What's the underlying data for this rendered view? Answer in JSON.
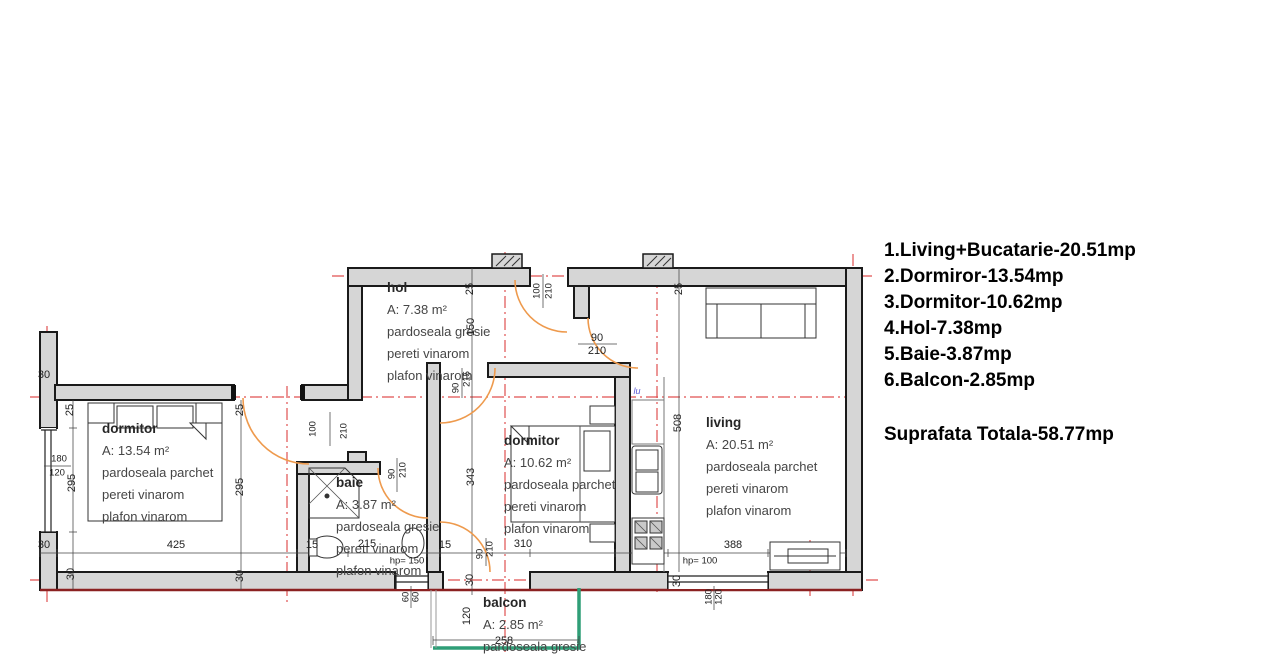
{
  "legend": {
    "items": [
      "1.Living+Bucatarie-20.51mp",
      "2.Dormiror-13.54mp",
      "3.Dormitor-10.62mp",
      "4.Hol-7.38mp",
      "5.Baie-3.87mp",
      "6.Balcon-2.85mp"
    ],
    "total": "Suprafata Totala-58.77mp"
  },
  "rooms": {
    "hol": {
      "name": "hol",
      "area": "A: 7.38 m²",
      "lines": [
        "pardoseala gresie",
        "pereti vinarom",
        "plafon vinarom"
      ]
    },
    "dormitor1": {
      "name": "dormitor",
      "area": "A: 13.54 m²",
      "lines": [
        "pardoseala parchet",
        "pereti vinarom",
        "plafon vinarom"
      ]
    },
    "baie": {
      "name": "baie",
      "area": "A: 3.87 m²",
      "lines": [
        "pardoseala gresie",
        "pereti vinarom",
        "plafon vinarom"
      ]
    },
    "dormitor2": {
      "name": "dormitor",
      "area": "A: 10.62 m²",
      "lines": [
        "pardoseala parchet",
        "pereti vinarom",
        "plafon vinarom"
      ]
    },
    "living": {
      "name": "living",
      "area": "A: 20.51 m²",
      "lines": [
        "pardoseala parchet",
        "pereti vinarom",
        "plafon vinarom"
      ]
    },
    "balcon": {
      "name": "balcon",
      "area": "A: 2.85 m²",
      "lines": [
        "pardoseala gresie"
      ]
    }
  },
  "dims": {
    "d15": "15",
    "d25": "25",
    "d30": "30",
    "d60": "60",
    "d90": "90",
    "d100": "100",
    "d120": "120",
    "d150": "150",
    "d180": "180",
    "d210": "210",
    "d215": "215",
    "d258": "258",
    "d295": "295",
    "d310": "310",
    "d343": "343",
    "d388": "388",
    "d425": "425",
    "d508": "508"
  },
  "annotations": {
    "hp150": "hp= 150",
    "hp100": "hp= 100",
    "lu": "lu"
  },
  "colors": {
    "wall_fill": "#d6d6d6",
    "wall_stroke": "#1a1a1a",
    "axis_red": "#e05050",
    "door_orange": "#ee9a4d",
    "balcony_green": "#2f9e77",
    "accent_maroon": "#8b2121"
  }
}
